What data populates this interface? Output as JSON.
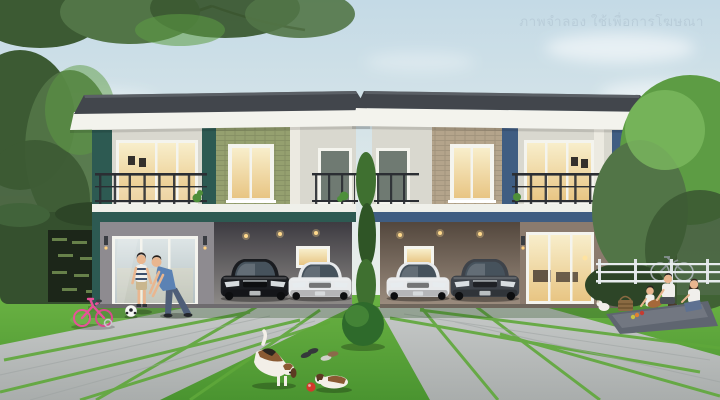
{
  "watermark": {
    "text": "ภาพจำลอง ใช้เพื่อการโฆษณา",
    "color": "#b9cdd9"
  },
  "colors": {
    "sky_top": "#c4dae6",
    "sky_mid": "#e2ebea",
    "sky_bottom": "#f3f4ec",
    "cloud": "#ffffff",
    "tree_dark": "#3c5a33",
    "tree_mid": "#527547",
    "tree_bright": "#5d9c44",
    "tree_light": "#7cb95f",
    "hedge": "#35502e",
    "roof": "#42464c",
    "fascia": "#f3f3ed",
    "wall_upper": "#d9d8cf",
    "pilaster": "#eceae1",
    "brick_green": "#95a06f",
    "brick_tan": "#b4a48b",
    "accent_teal": "#2d5a52",
    "accent_blue": "#3f5d82",
    "wall_lower_left": "#8e8b90",
    "wall_lower_right": "#8b7b6e",
    "railing": "#2b2e33",
    "frame_white": "#f4f4ee",
    "glass_warm": "#f2dfae",
    "glass_cool": "#ccd5d5",
    "interior_glow": "#ffd98c",
    "lawn_light": "#6ab243",
    "lawn_dark": "#4a9430",
    "pavement_light": "#c8cbca",
    "pavement_dark": "#a9adac",
    "joint_green": "#5fa83a",
    "car_black": "#1a1c20",
    "car_white": "#e8eaec",
    "car_gray": "#3e434a",
    "ball_red": "#d5382c",
    "bike_pink": "#e8509a",
    "skin": "#e9b68f",
    "shirt_blue": "#5b82b4",
    "jeans": "#4e5e78",
    "shirt_white": "#f0efeb",
    "dog_white": "#f3efe8",
    "dog_brown": "#8a5a33",
    "blanket": "#5f6570",
    "basket": "#8a6a42",
    "bush": "#2e6a2b"
  }
}
